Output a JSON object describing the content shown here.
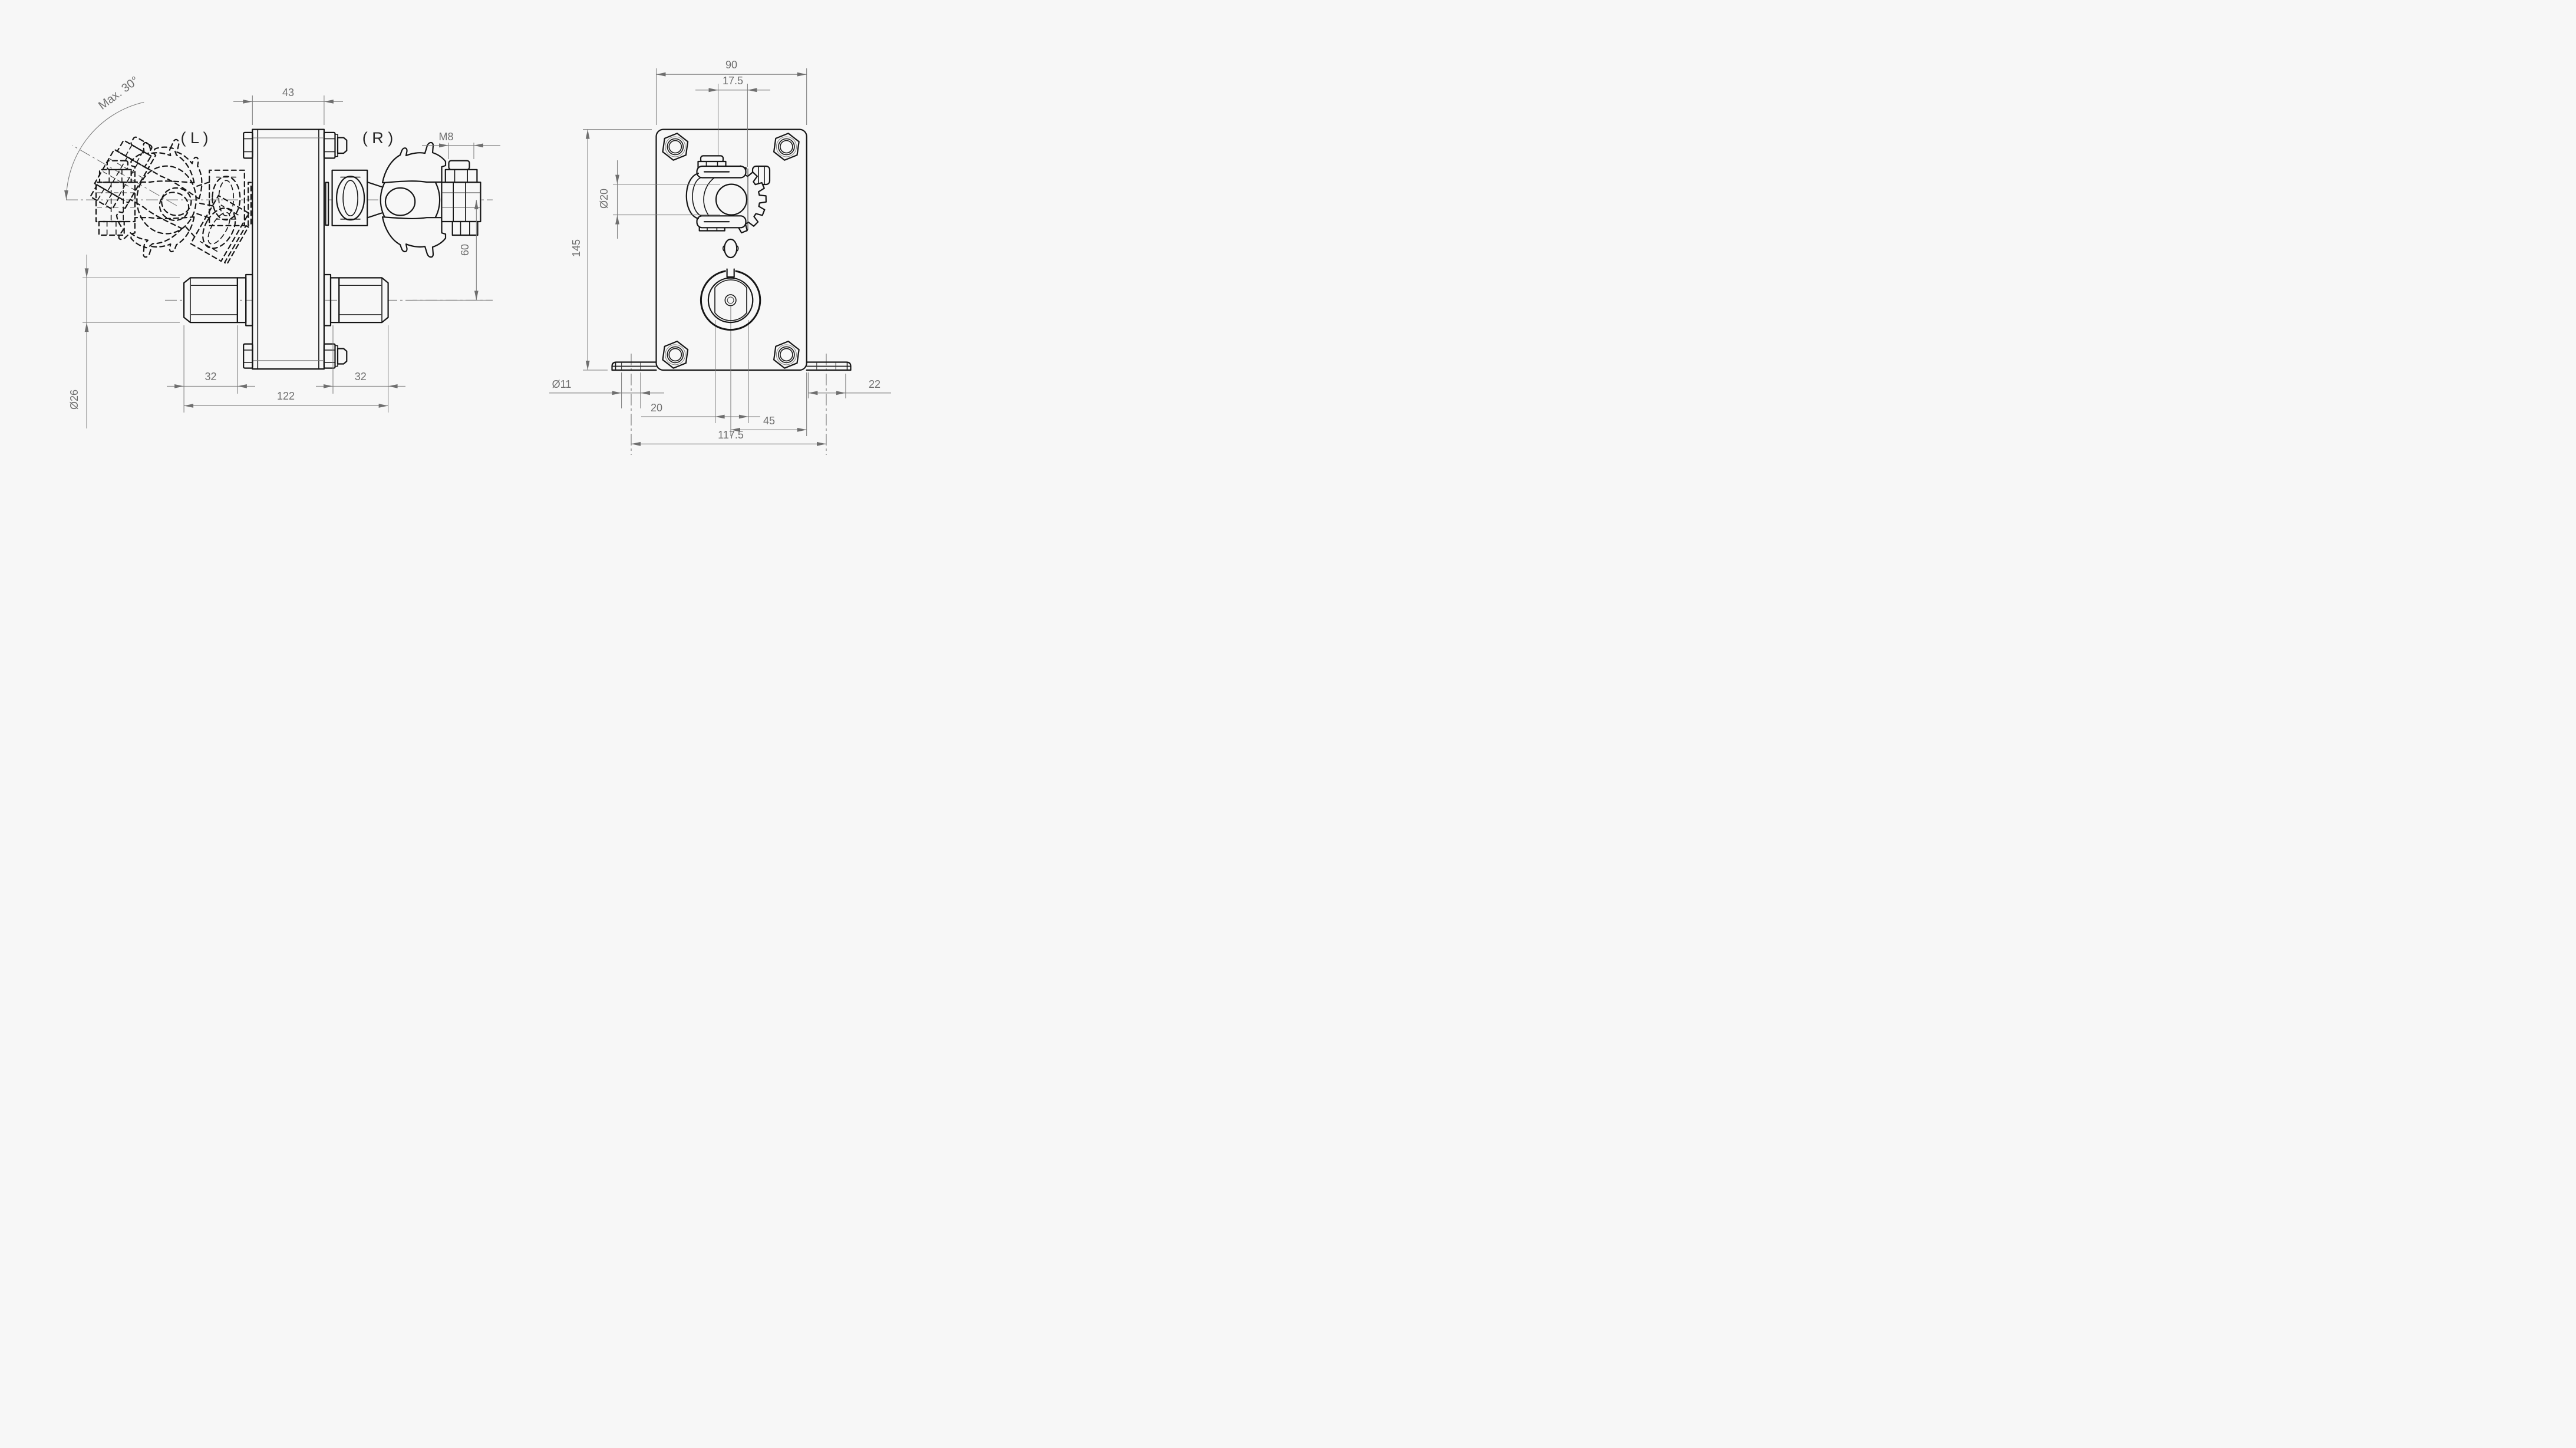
{
  "drawing": {
    "background": "#f7f7f7",
    "part_line_color": "#161616",
    "dimension_color": "#6e6e6e",
    "annotations": {
      "max_angle": "Max. 30°",
      "left_marker": "( L )",
      "right_marker": "( R )"
    },
    "side_view": {
      "dimensions": {
        "plate_width": "43",
        "thread": "M8",
        "clamp_to_tube": "60",
        "tube_left": "32",
        "tube_right": "32",
        "overall_width": "122",
        "tube_diameter": "Ø26"
      }
    },
    "front_view": {
      "dimensions": {
        "plate_width": "90",
        "clamp_offset": "17.5",
        "clamp_bore": "Ø20",
        "plate_height": "145",
        "hole_diameter": "Ø11",
        "socket_flats": "20",
        "center_to_edge": "45",
        "hole_spacing": "117.5",
        "edge_to_end": "22"
      }
    }
  }
}
